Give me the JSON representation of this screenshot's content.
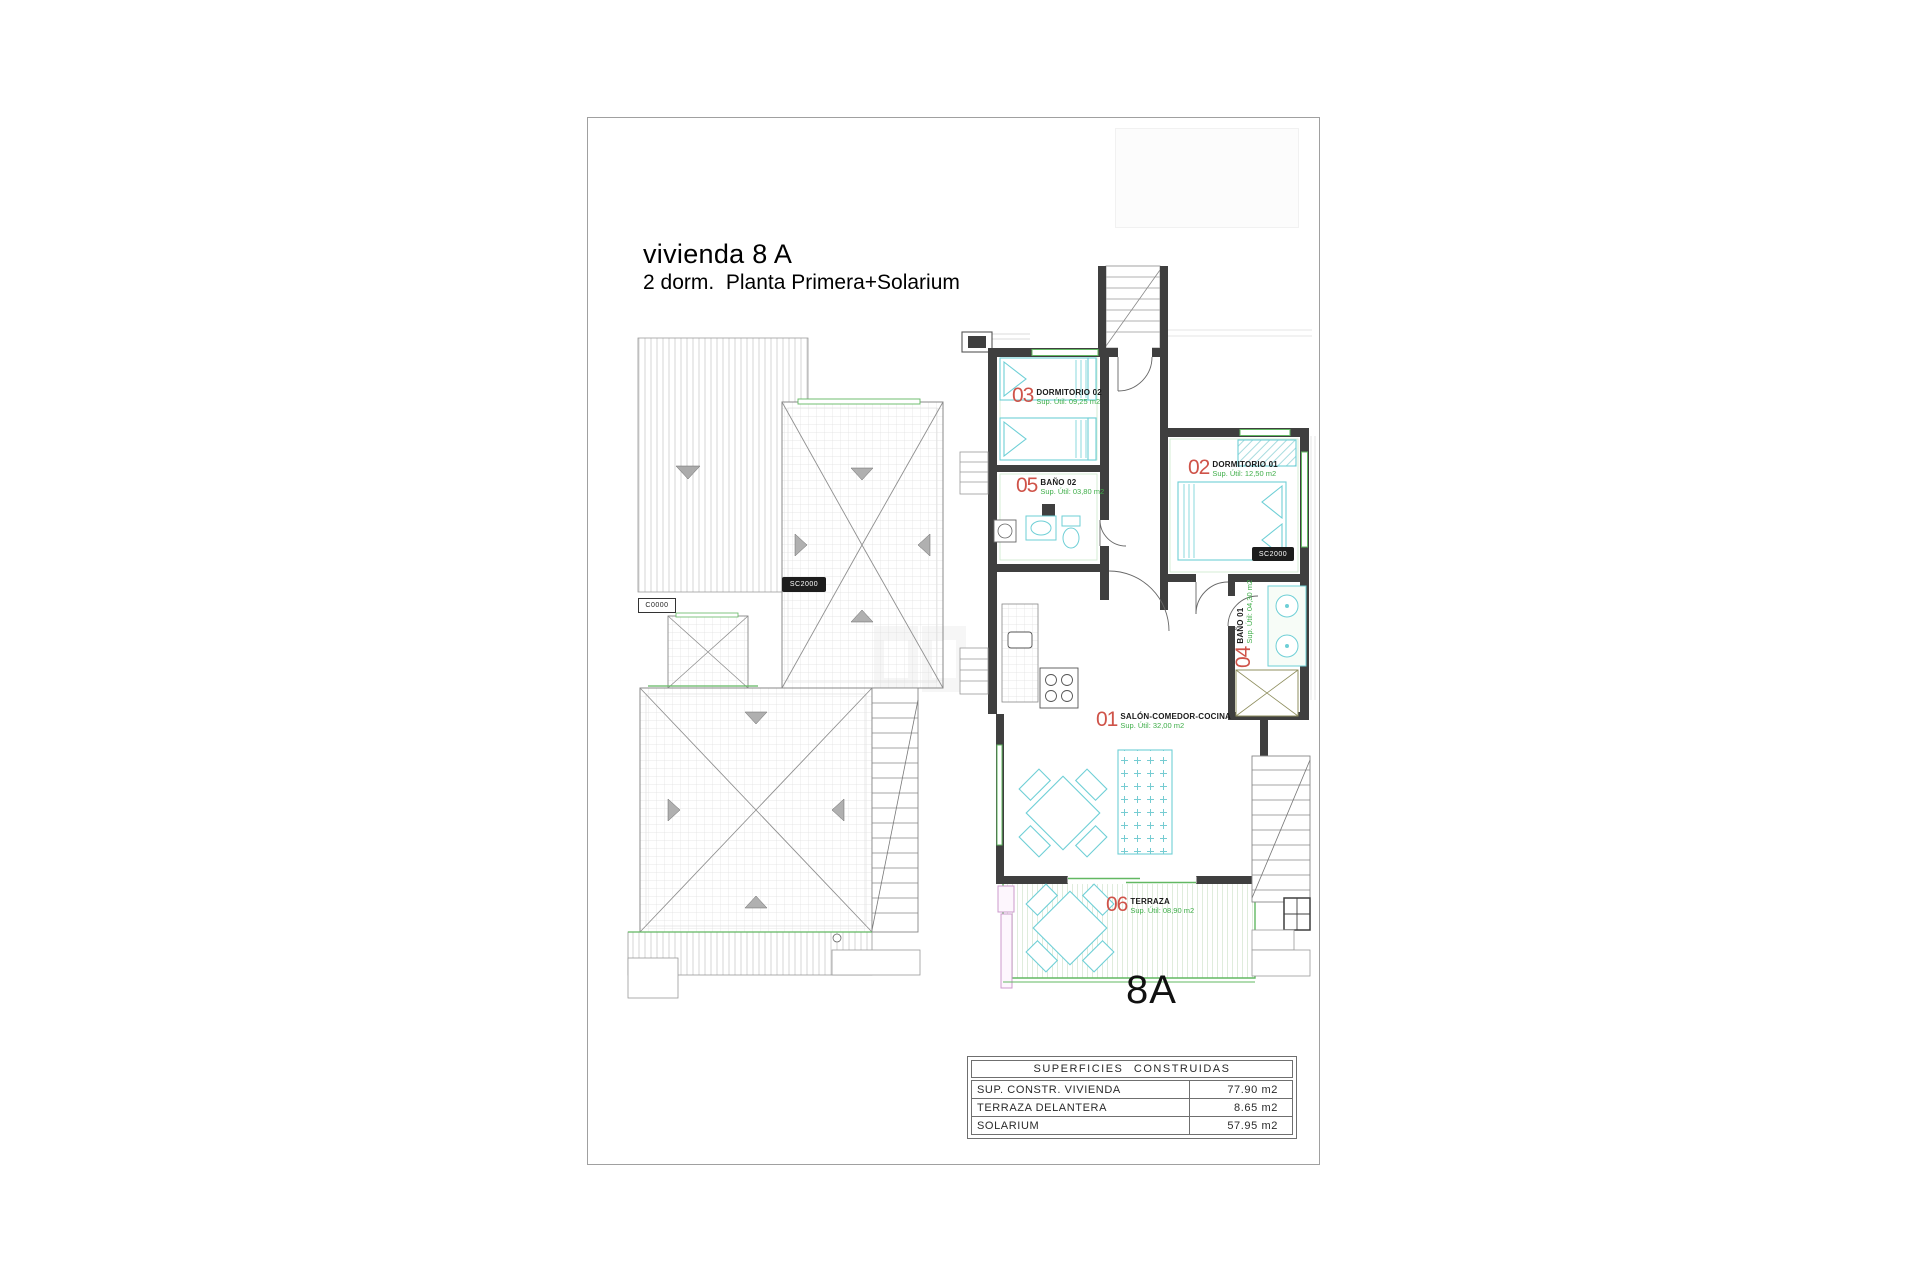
{
  "header": {
    "title": "vivienda 8 A",
    "subtitle": "2 dorm.  Planta Primera+Solarium"
  },
  "unit_label": "8A",
  "rooms": {
    "salon": {
      "num": "01",
      "name": "SALÓN-COMEDOR-COCINA",
      "area": "Sup. Útil: 32,00 m2"
    },
    "dormitorio1": {
      "num": "02",
      "name": "DORMITORIO 01",
      "area": "Sup. Útil: 12,50 m2"
    },
    "dormitorio2": {
      "num": "03",
      "name": "DORMITORIO 02",
      "area": "Sup. Útil: 09,25 m2"
    },
    "bano1": {
      "num": "04",
      "name": "BAÑO 01",
      "area": "Sup. Útil: 04,30 m2"
    },
    "bano2": {
      "num": "05",
      "name": "BAÑO 02",
      "area": "Sup. Útil: 03,80 m2"
    },
    "terraza": {
      "num": "06",
      "name": "TERRAZA",
      "area": "Sup. Útil: 08,90 m2"
    }
  },
  "equipment_tags": {
    "roof_black": "SC2000",
    "roof_white": "C0000",
    "indoor_black": "SC2000"
  },
  "areas_table": {
    "header": "SUPERFICIES CONSTRUIDAS",
    "rows": [
      {
        "label": "SUP. CONSTR. VIVIENDA",
        "value": "77.90 m2"
      },
      {
        "label": "TERRAZA DELANTERA",
        "value": "8.65 m2"
      },
      {
        "label": "SOLARIUM",
        "value": "57.95 m2"
      }
    ]
  },
  "colors": {
    "room_number_red": "#cf5349",
    "area_text_green": "#3fae49",
    "window_green": "#62b862",
    "furniture_cyan": "#6ecfd6",
    "wall_dark": "#3f3f3f"
  }
}
